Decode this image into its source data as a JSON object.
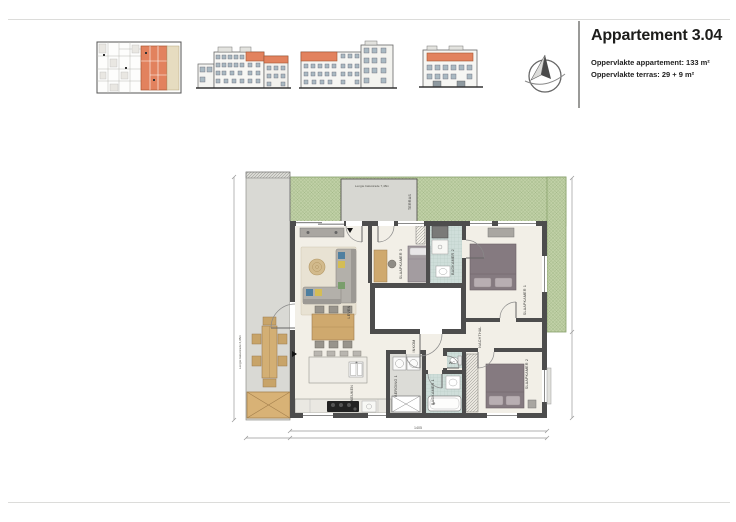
{
  "header": {
    "title": "Appartement 3.04",
    "area_apartment": "Oppervlakte appartement: 133 m²",
    "area_terrace": "Oppervlakte terras: 29 + 9 m²"
  },
  "icons": {
    "compass": "north-arrow-compass-icon"
  },
  "plan": {
    "rooms": {
      "terras": "TERRAS",
      "leven": "LEVEN",
      "keuken": "KEUKEN",
      "inkom": "INKOM",
      "berging": "BERGING 1",
      "badkamer1": "BADKAMER 1",
      "wc": "WC",
      "nachthal": "NACHTHAL",
      "slaapkamer1": "SLAAPKAMER 1",
      "slaapkamer2": "SLAAPKAMER 2",
      "slaapkamer3": "SLAAPKAMER 3",
      "badkamer2": "BADKAMER 2"
    },
    "annotations": {
      "balustrade_top": "Lengte balustrade 7,48m",
      "balustrade_left": "Lengte balustrade 2,95m"
    },
    "dimensions": {
      "bottom_total": "1405"
    },
    "colors": {
      "terrace_green": "#c0d0a6",
      "floor": "#f2efe7",
      "wall": "#4d4d4d",
      "tile": "#cfdeda",
      "wood": "#cfa96e",
      "highlight_orange": "#e2825e"
    }
  }
}
